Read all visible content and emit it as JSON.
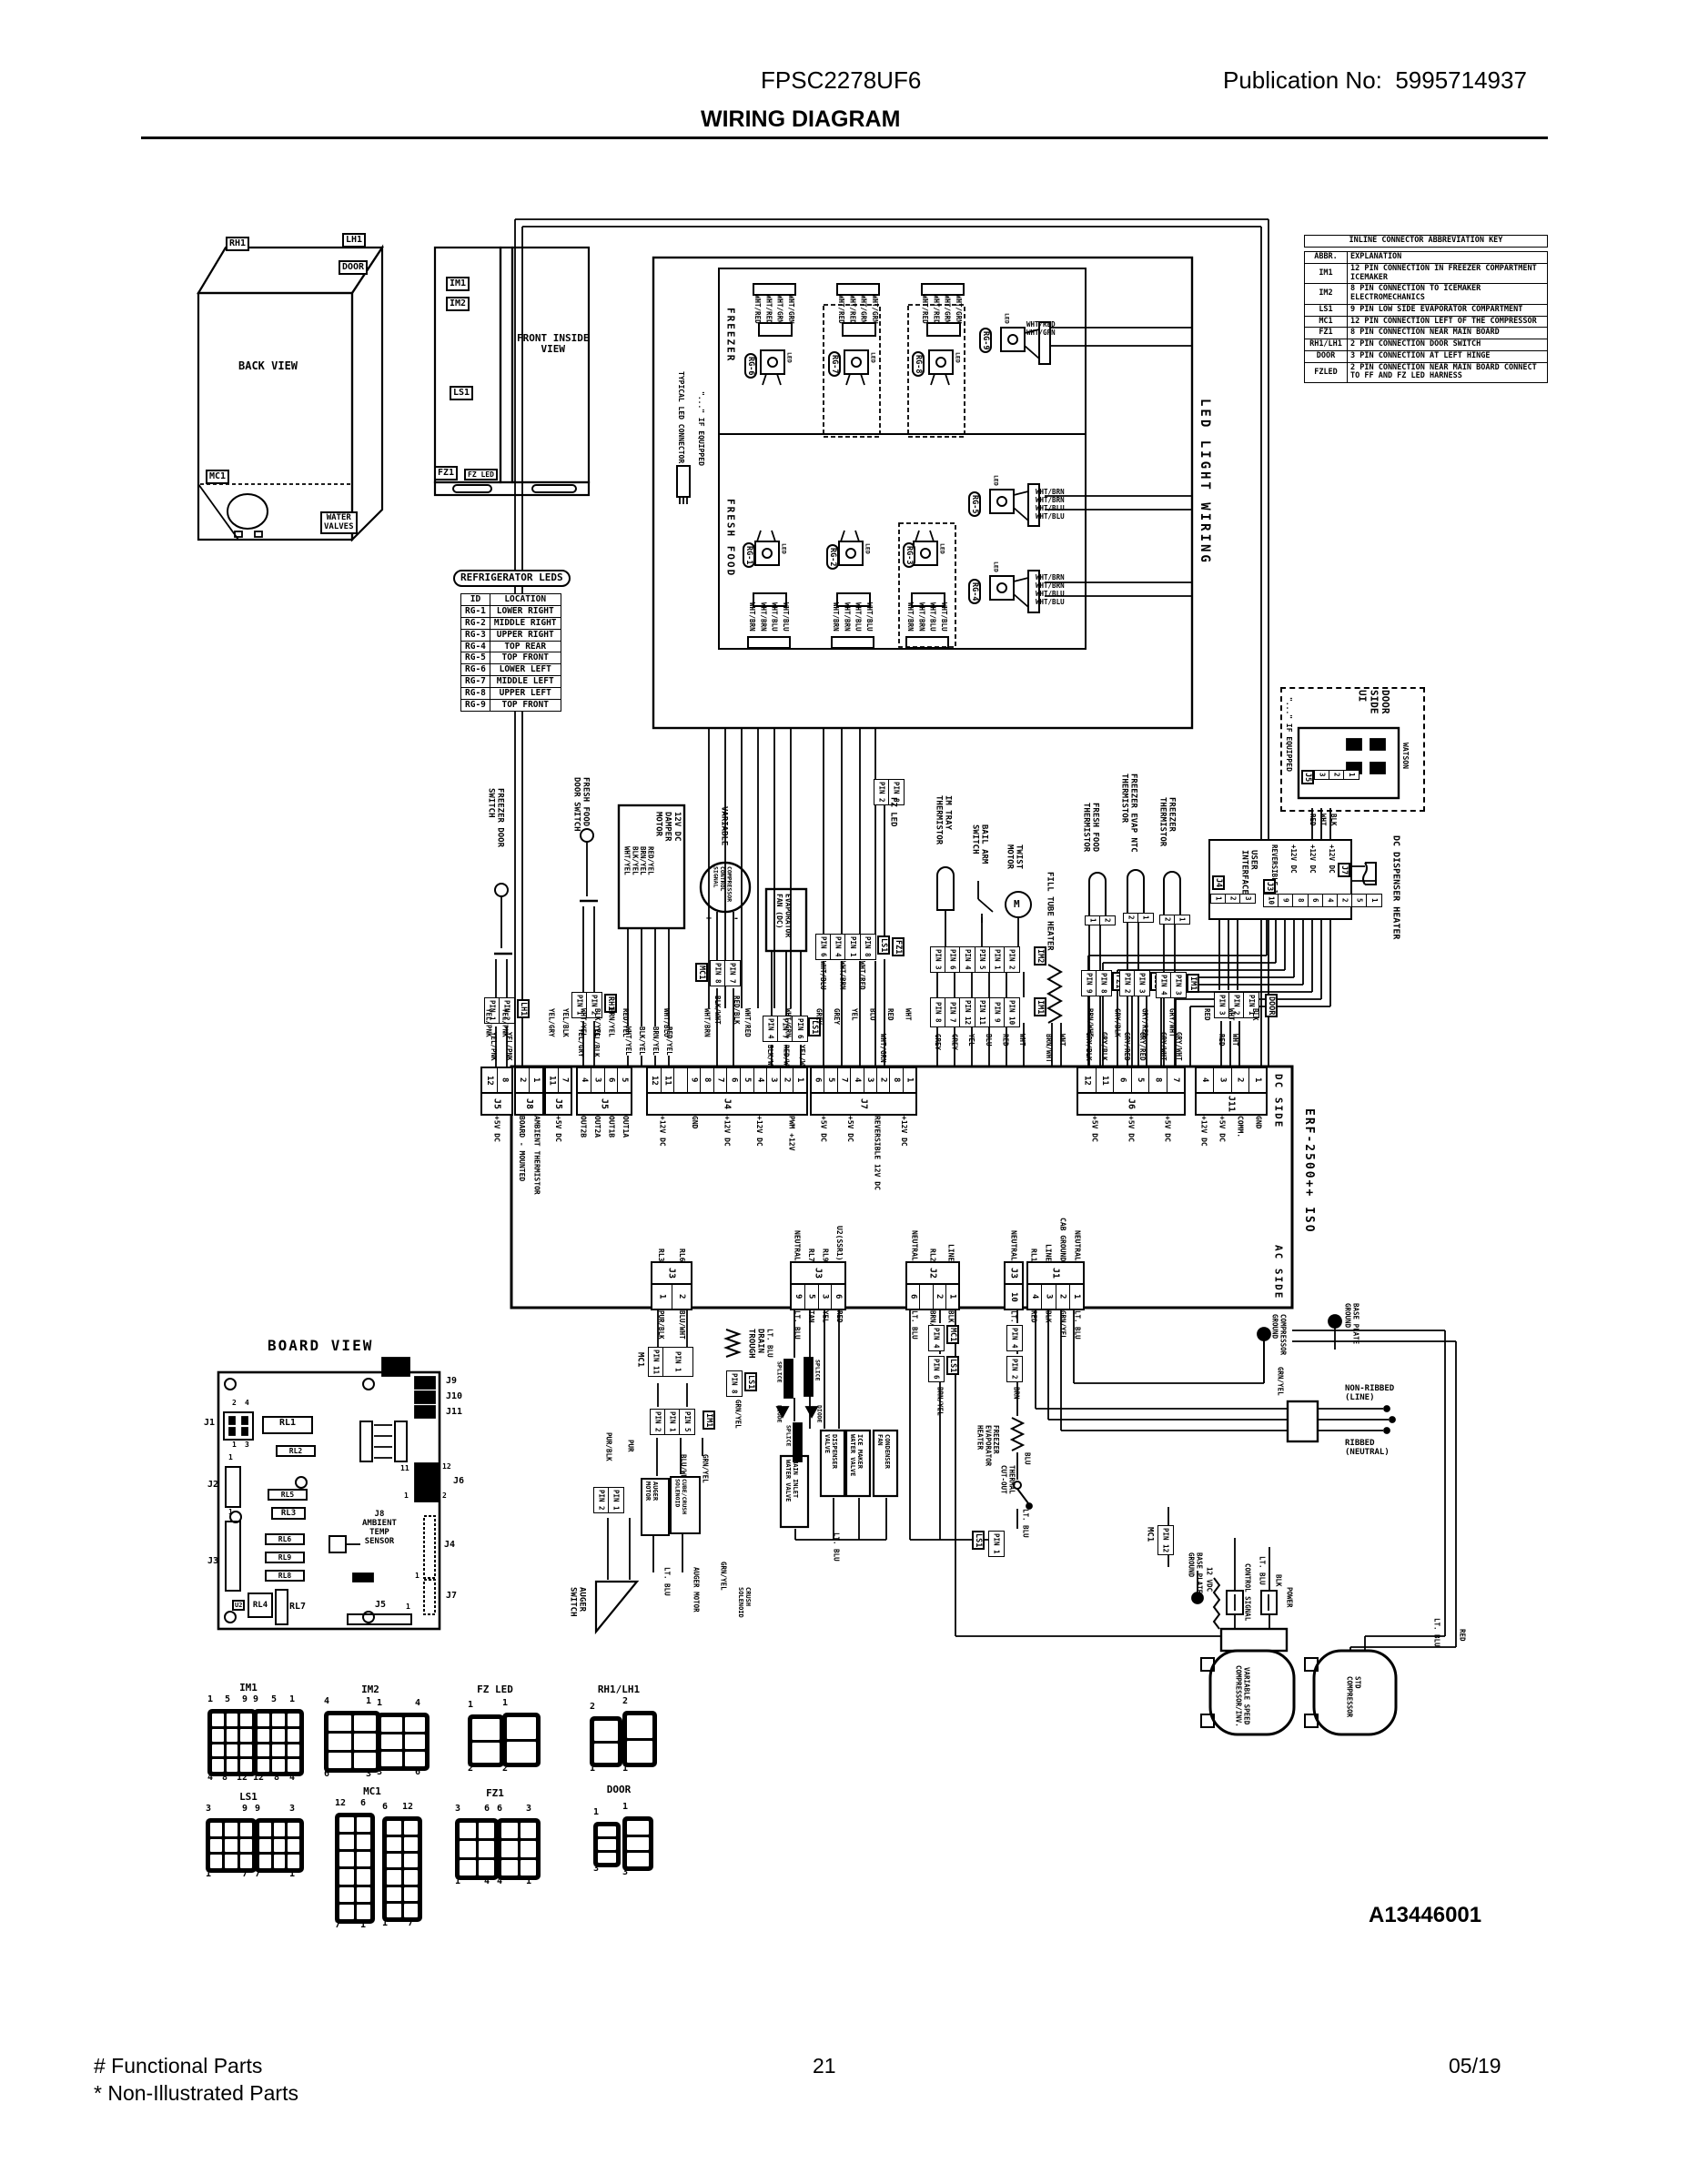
{
  "header": {
    "model": "FPSC2278UF6",
    "publication": "Publication No:  5995714937",
    "title": "WIRING DIAGRAM"
  },
  "footer": {
    "functional_parts": "# Functional Parts",
    "non_illustrated_parts": "* Non-Illustrated Parts",
    "page_number": "21",
    "date": "05/19",
    "drawing_number": "A13446001"
  },
  "back_view": {
    "title": "BACK VIEW",
    "rh1": "RH1",
    "lh1": "LH1",
    "door": "DOOR",
    "mc1": "MC1",
    "water_valves": "WATER\nVALVES"
  },
  "front_view": {
    "title": "FRONT INSIDE\nVIEW",
    "im1": "IM1",
    "im2": "IM2",
    "ls1": "LS1",
    "fz1": "FZ1",
    "fz_led": "FZ LED"
  },
  "led_table": {
    "title": "REFRIGERATOR LEDS",
    "rows": [
      [
        "ID",
        "LOCATION"
      ],
      [
        "RG-1",
        "LOWER RIGHT"
      ],
      [
        "RG-2",
        "MIDDLE RIGHT"
      ],
      [
        "RG-3",
        "UPPER RIGHT"
      ],
      [
        "RG-4",
        "TOP REAR"
      ],
      [
        "RG-5",
        "TOP FRONT"
      ],
      [
        "RG-6",
        "LOWER LEFT"
      ],
      [
        "RG-7",
        "MIDDLE LEFT"
      ],
      [
        "RG-8",
        "UPPER LEFT"
      ],
      [
        "RG-9",
        "TOP FRONT"
      ]
    ]
  },
  "key_table": {
    "title": "INLINE CONNECTOR ABBREVIATION KEY",
    "rows": [
      [
        "ABBR.",
        "EXPLANATION"
      ],
      [
        "IM1",
        "12 PIN CONNECTION IN FREEZER COMPARTMENT ICEMAKER"
      ],
      [
        "IM2",
        "8 PIN CONNECTION TO ICEMAKER ELECTROMECHANICS"
      ],
      [
        "LS1",
        "9 PIN LOW SIDE EVAPORATOR COMPARTMENT"
      ],
      [
        "MC1",
        "12 PIN CONNECTION LEFT OF THE COMPRESSOR"
      ],
      [
        "FZ1",
        "8 PIN CONNECTION NEAR MAIN BOARD"
      ],
      [
        "RH1/LH1",
        "2 PIN CONNECTION DOOR SWITCH"
      ],
      [
        "DOOR",
        "3 PIN CONNECTION AT LEFT HINGE"
      ],
      [
        "FZLED",
        "2 PIN CONNECTION NEAR MAIN BOARD CONNECT TO FF AND FZ LED HARNESS"
      ]
    ]
  },
  "led_wiring": {
    "freezer": "FREEZER",
    "fresh_food": "FRESH FOOD",
    "side_label": "LED LIGHT WIRING",
    "typical_connector": "TYPICAL LED CONNECTOR",
    "if_equipped": "\"...\" IF EQUIPPED",
    "led": "LED",
    "freezer_leds": [
      "RG-6",
      "RG-7",
      "RG-8"
    ],
    "rg9": "RG-9",
    "rg9_wires": [
      "WHT/RED",
      "WHT/GRN"
    ],
    "fresh_leds": [
      "RG-1",
      "RG-2",
      "RG-3"
    ],
    "rg5": "RG-5",
    "rg4": "RG-4",
    "freezer_wires": [
      "WHT/RED",
      "WHT/RED",
      "WHT/GRN",
      "WHT/GRN"
    ],
    "fresh_wires": [
      "WHT/BRN",
      "WHT/BRN",
      "WHT/BLU",
      "WHT/BLU"
    ]
  },
  "door_ui": {
    "title": "DOOR\nSIDE\nUI",
    "if_equipped": "\"...\" IF EQUIPPED",
    "watson": "WATSON",
    "j5": "J5",
    "j5_pins": [
      "3",
      "2",
      "1"
    ],
    "j5_wires": [
      "RED",
      "WHT",
      "BLK"
    ],
    "heater_label": "DC DISPENSER HEATER",
    "ui_title": "USER\nINTERFACE",
    "j4": "J4",
    "j4_pins": [
      "1",
      "2",
      "3"
    ],
    "j3": "J3",
    "j3_pins": [
      "10",
      "9",
      "8",
      "6",
      "4",
      "2",
      "5",
      "1"
    ],
    "j3_signals": [
      "REVERSIBLE 12V",
      "+12V DC",
      "+12V DC",
      "+12V DC"
    ],
    "j7": "J7",
    "j7_pins": [
      "2",
      "1"
    ]
  },
  "components": [
    {
      "label": "FREEZER DOOR\nSWITCH",
      "conn": "LH1",
      "pins": [
        "PIN 1",
        "PIN 2"
      ],
      "wires": [
        "YEL/PNK",
        "YEL/PNK"
      ]
    },
    {
      "label": "FRESH FOOD\nDOOR SWITCH",
      "conn": "RH1",
      "pins": [
        "PIN 1",
        "PIN 2"
      ],
      "wires": [
        "YEL/GRY",
        "YEL/BLK"
      ]
    },
    {
      "label": "12V DC\nDAMPER\nMOTOR",
      "box_wires": "RED/YEL\nBRN/YEL\nBLK/YEL\nWHT/YEL",
      "pins": [
        "4",
        "1"
      ],
      "wires": [
        "WHT/YEL",
        "BLK/YEL",
        "BRN/YEL",
        "RED/YEL"
      ]
    },
    {
      "label": "VARIABLE",
      "sub": "COMPRESSOR\nCONTROL\nSIGNAL",
      "plus": "+",
      "minus": "-",
      "conn": "MC1",
      "pins": [
        "PIN 8",
        "PIN 7"
      ],
      "wires": [
        "BLK/WHT",
        "RED/BLK"
      ]
    },
    {
      "label": "EVAPORATOR\nFAN (DC)",
      "conn": "LS1",
      "pins": [
        "PIN 4",
        "PIN 7",
        "PIN 6"
      ],
      "wires": [
        "BLK/WHT",
        "RED/WHT",
        "YEL/WHT"
      ]
    },
    {
      "label": "LS1",
      "pins": [
        "PIN 6",
        "PIN 4",
        "PIN 1",
        "PIN 8"
      ],
      "wires": [
        "WHT/BLU",
        "WHT/BRN",
        "WHT/RED"
      ]
    },
    {
      "label": "FZ LED",
      "conn": "FZ1",
      "pins": [
        "PIN 2",
        "PIN 8"
      ],
      "wires": [
        "WHT/GRN"
      ]
    },
    {
      "label": "IM TRAY\nTHERMISTOR"
    },
    {
      "label": "BAIL ARM\nSWITCH"
    },
    {
      "label": "TWIST\nMOTOR",
      "m": "M"
    },
    {
      "label": "FILL TUBE HEATER",
      "wires": [
        "BRN/WHT",
        "WHT"
      ]
    },
    {
      "label": "IM2",
      "pins": [
        "PIN 3",
        "PIN 6",
        "PIN 4",
        "PIN 5",
        "PIN 1",
        "PIN 2"
      ]
    },
    {
      "label": "IM1",
      "pins": [
        "PIN 8",
        "PIN 7",
        "PIN 12",
        "PIN 11",
        "PIN 9",
        "PIN 10"
      ],
      "wires": [
        "GREY",
        "GREY",
        "YEL",
        "BLU",
        "RED",
        "WHT"
      ]
    },
    {
      "label": "FRESH FOOD\nTHERMISTOR",
      "conn": "FZ1",
      "small": [
        "1",
        "2"
      ],
      "pins": [
        "PIN 9",
        "PIN 8"
      ],
      "wires": [
        "GRY/BLK",
        "GRY/BLK"
      ]
    },
    {
      "label": "FREEZER EVAP NTC\nTHERMISTOR",
      "conn": "LS1",
      "small": [
        "2",
        "1"
      ],
      "pins": [
        "PIN 2",
        "PIN 3"
      ],
      "wires": [
        "GRY/RED",
        "GRY/RED"
      ]
    },
    {
      "label": "FREEZER\nTHERMISTOR",
      "conn": "IM1",
      "small": [
        "2",
        "1"
      ],
      "pins": [
        "PIN 4",
        "PIN 3"
      ],
      "wires": [
        "GRY/WHT",
        "GRY/WHT"
      ]
    },
    {
      "label": "DOOR",
      "pins": [
        "PIN 3",
        "PIN 2",
        "PIN 1"
      ],
      "wires": [
        "RED",
        "WHT"
      ]
    }
  ],
  "board": {
    "dc_side": "DC SIDE",
    "ac_side": "AC SIDE",
    "iso": "ERF-2500++ ISO",
    "dc_connectors": [
      {
        "name": "J5",
        "pins": [
          "12",
          "8"
        ],
        "signals": [
          "+5V DC"
        ],
        "wires": [
          "YEL/PNK",
          "YEL/PNK"
        ]
      },
      {
        "name": "J8",
        "pins": [
          "2",
          "1"
        ],
        "signals": [
          "BOARD - MOUNTED",
          "AMBIENT THERMISTOR"
        ],
        "wires": []
      },
      {
        "name": "J5",
        "pins": [
          "11",
          "7"
        ],
        "signals": [
          "+5V DC"
        ],
        "wires": [
          "YEL/GRY",
          "YEL/BLK"
        ]
      },
      {
        "name": "J5",
        "pins": [
          "4",
          "3",
          "6",
          "5"
        ],
        "signals": [
          "OUT2B",
          "OUT2A",
          "OUT1B",
          "OUT1A"
        ],
        "wires": [
          "WHT/YEL",
          "BLK/YEL",
          "BRN/YEL",
          "RED/YEL"
        ]
      },
      {
        "name": "J4",
        "pins": [
          "12",
          "11",
          "",
          "9",
          "8",
          "7",
          "6",
          "5",
          "4",
          "3",
          "2",
          "1"
        ],
        "signals": [
          "+12V DC",
          "GND",
          "+12V DC",
          "+12V DC",
          "PWM +12V"
        ],
        "wires": [
          "WHT/BLU",
          "WHT/BRN",
          "WHT/RED",
          "WHT/GRN"
        ]
      },
      {
        "name": "J7",
        "pins": [
          "6",
          "5",
          "7",
          "4",
          "3",
          "2",
          "8",
          "1"
        ],
        "signals": [
          "+5V DC",
          "+5V DC",
          "REVERSIBLE 12V DC",
          "+12V DC"
        ],
        "wires": [
          "GREY",
          "GREY",
          "YEL",
          "BLU",
          "RED",
          "WHT"
        ]
      },
      {
        "name": "J6",
        "pins": [
          "12",
          "11",
          "6",
          "5",
          "8",
          "7"
        ],
        "signals": [
          "+5V DC",
          "+5V DC",
          "+5V DC"
        ],
        "wires": [
          "BRN/WHT",
          "GRY/BLK",
          "GRY/RED",
          "GRY/WHT"
        ]
      },
      {
        "name": "J11",
        "pins": [
          "4",
          "3",
          "2",
          "1"
        ],
        "signals": [
          "+12V DC",
          "+5V DC",
          "COMM.",
          "GND"
        ],
        "wires": [
          "RED",
          "WHT",
          "BLK"
        ]
      }
    ],
    "ac_connectors": [
      {
        "name": "J3",
        "pins": [
          "1",
          "2"
        ],
        "signals": [
          "RL3",
          "RL6"
        ],
        "wires": [
          "PUR/BLK",
          "BLU/WHT"
        ]
      },
      {
        "name": "J3",
        "pins": [
          "9",
          "5",
          "3",
          "6"
        ],
        "signals": [
          "NEUTRAL",
          "RL7",
          "RL9",
          "U2(SSR1)"
        ],
        "wires": [
          "LT. BLU",
          "TAN",
          "YEL",
          "RED"
        ]
      },
      {
        "name": "J2",
        "pins": [
          "6",
          "",
          "2",
          "1"
        ],
        "signals": [
          "NEUTRAL",
          "RL2",
          "LINE"
        ],
        "wires": [
          "LT. BLU",
          "BRN/YEL",
          "BLK"
        ]
      },
      {
        "name": "J3",
        "pins": [
          "10"
        ],
        "signals": [
          "NEUTRAL"
        ],
        "wires": [
          "LT. BLU"
        ]
      },
      {
        "name": "J1",
        "pins": [
          "4",
          "3",
          "2",
          "1"
        ],
        "signals": [
          "RL1",
          "LINE",
          "CAB GROUND",
          "NEUTRAL"
        ],
        "wires": [
          "RED",
          "BLK",
          "GRN/YEL",
          "LT. BLU"
        ]
      }
    ]
  },
  "lower": {
    "mc1": "MC1",
    "im1": "IM1",
    "ls1": "LS1",
    "pin1": "PIN 1",
    "pin2": "PIN 2",
    "pin4": "PIN 4",
    "pin5": "PIN 5",
    "pin8": "PIN 8",
    "pin11": "PIN 11",
    "pin12": "PIN 12",
    "pin6": "PIN 6",
    "auger_switch": "AUGER\nSWITCH",
    "auger_motor": "AUGER\nMOTOR",
    "auger_motor_w": "AUGER MOTOR",
    "cube_crush": "CUBE/CRUSH\nSOLENOID",
    "crush_solenoid": "CRUSH\nSOLENOID",
    "drain_trough": "DRAIN\nTROUGH",
    "splice": "SPLICE",
    "diode": "DIODE",
    "main_inlet": "MAIN INLET\nWATER VALVE",
    "dispenser_valve": "DISPENSER\nVALVE",
    "ice_maker_valve": "ICE MAKER\nWATER VALVE",
    "condenser_fan": "CONDENSER\nFAN",
    "fz_evap_heater": "FREEZER\nEVAPORATOR\nHEATER",
    "thermal_cutout": "THERMAL\nCUT-OUT",
    "compressor_ground": "COMPRESSOR\nGROUND",
    "base_plate_ground": "BASE PLATE\nGROUND",
    "non_ribbed": "NON-RIBBED\n(LINE)",
    "ribbed": "RIBBED\n(NEUTRAL)",
    "vdc12": "12 VDC",
    "control_signal": "CONTROL SIGNAL",
    "power": "POWER",
    "var_compressor": "VARIABLE SPEED\nCOMPRESSOR/INV.",
    "std_compressor": "STD\nCOMPRESSOR",
    "w_purblk": "PUR/BLK",
    "w_pur": "PUR",
    "w_bluwht": "BLU/WHT",
    "w_grnyel": "GRN/YEL",
    "w_ltblu": "LT. BLU",
    "w_tan": "TAN",
    "w_yel": "YEL",
    "w_red": "RED",
    "w_blk": "BLK",
    "w_brn": "BRN",
    "w_brnyel": "BRN/YEL",
    "w_blu": "BLU"
  },
  "board_view": {
    "title": "BOARD VIEW",
    "j1": "J1",
    "j2": "J2",
    "j3": "J3",
    "j4": "J4",
    "j5": "J5",
    "j6": "J6",
    "j7": "J7",
    "j9": "J9",
    "j10": "J10",
    "j11": "J11",
    "j8": "J8\nAMBIENT\nTEMP\nSENSOR",
    "rl1": "RL1",
    "rl2": "RL2",
    "rl3": "RL3",
    "rl4": "RL4",
    "rl5": "RL5",
    "rl6": "RL6",
    "rl7": "RL7",
    "rl8": "RL8",
    "rl9": "RL9",
    "u2": "U2",
    "p1": "1",
    "p2": "2",
    "p3": "3",
    "p4": "4",
    "p11": "11",
    "p12": "12"
  },
  "connector_views": {
    "row1": [
      {
        "title": "IM1",
        "lt": [
          "1",
          "5",
          "9"
        ],
        "lb": [
          "4",
          "8",
          "12"
        ],
        "rt": [
          "9",
          "5",
          "1"
        ],
        "rb": [
          "12",
          "8",
          "4"
        ]
      },
      {
        "title": "IM2",
        "lt": [
          "4",
          "1"
        ],
        "lb": [
          "6",
          "3"
        ],
        "rt": [
          "1",
          "4"
        ],
        "rb": [
          "3",
          "6"
        ]
      },
      {
        "title": "FZ LED",
        "lt": [
          "1"
        ],
        "lb": [
          "2"
        ],
        "rt": [
          "1"
        ],
        "rb": [
          "2"
        ]
      },
      {
        "title": "RH1/LH1",
        "lt": [
          "2"
        ],
        "lb": [
          "1"
        ],
        "rt": [
          "2"
        ],
        "rb": [
          "1"
        ]
      }
    ],
    "row2": [
      {
        "title": "LS1",
        "lt": [
          "3",
          "9"
        ],
        "lb": [
          "1",
          "7"
        ],
        "rt": [
          "9",
          "3"
        ],
        "rb": [
          "7",
          "1"
        ]
      },
      {
        "title": "MC1",
        "lt": [
          "12",
          "6"
        ],
        "lb": [
          "7",
          "1"
        ],
        "rt": [
          "6",
          "12"
        ],
        "rb": [
          "1",
          "7"
        ]
      },
      {
        "title": "FZ1",
        "lt": [
          "3",
          "6"
        ],
        "lb": [
          "1",
          "4"
        ],
        "rt": [
          "6",
          "3"
        ],
        "rb": [
          "4",
          "1"
        ]
      },
      {
        "title": "DOOR",
        "lt": [
          "1"
        ],
        "lb": [
          "3"
        ],
        "rt": [
          "1"
        ],
        "rb": [
          "3"
        ]
      }
    ]
  }
}
